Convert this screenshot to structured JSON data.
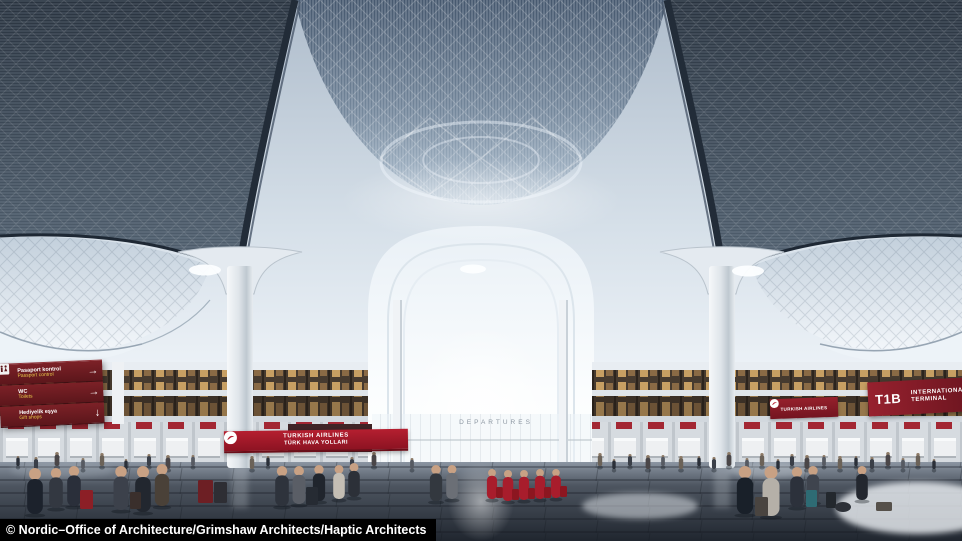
{
  "scene": {
    "description": "Architectural rendering of a vast airport departures hall with vaulted latticed ceiling, flared white columns, mezzanine shops, check-in counters and travellers",
    "departures_sign": "DEPARTURES"
  },
  "wayfinding_sign": {
    "items": [
      {
        "label_tr": "Pasaport kontrol",
        "label_en": "Passport control",
        "icon": "passport-control-icon",
        "arrow": "→"
      },
      {
        "label_tr": "WC",
        "label_en": "Toilets",
        "icon": "toilets-icon",
        "arrow": "→"
      },
      {
        "label_tr": "Hediyelik eşya",
        "label_en": "Gift shops",
        "icon": "gift-shops-icon",
        "arrow": "↓"
      }
    ]
  },
  "airline_banner": {
    "name": "TURKISH AIRLINES",
    "name_tr": "TÜRK HAVA YOLLARI"
  },
  "airline_banner_small": {
    "name": "TURKISH AIRLINES"
  },
  "terminal_sign": {
    "code": "T1B",
    "line1": "INTERNATIONAL",
    "line2": "TERMINAL"
  },
  "caption": {
    "text": "© Nordic–Office of Architecture/Grimshaw Architects/Haptic Architects"
  },
  "colors": {
    "airline_red": "#b51f30",
    "sign_maroon": "#6f1d23",
    "terminal_sign_red": "#8c1f2b",
    "caption_bg": "#000000",
    "caption_text": "#ffffff"
  }
}
